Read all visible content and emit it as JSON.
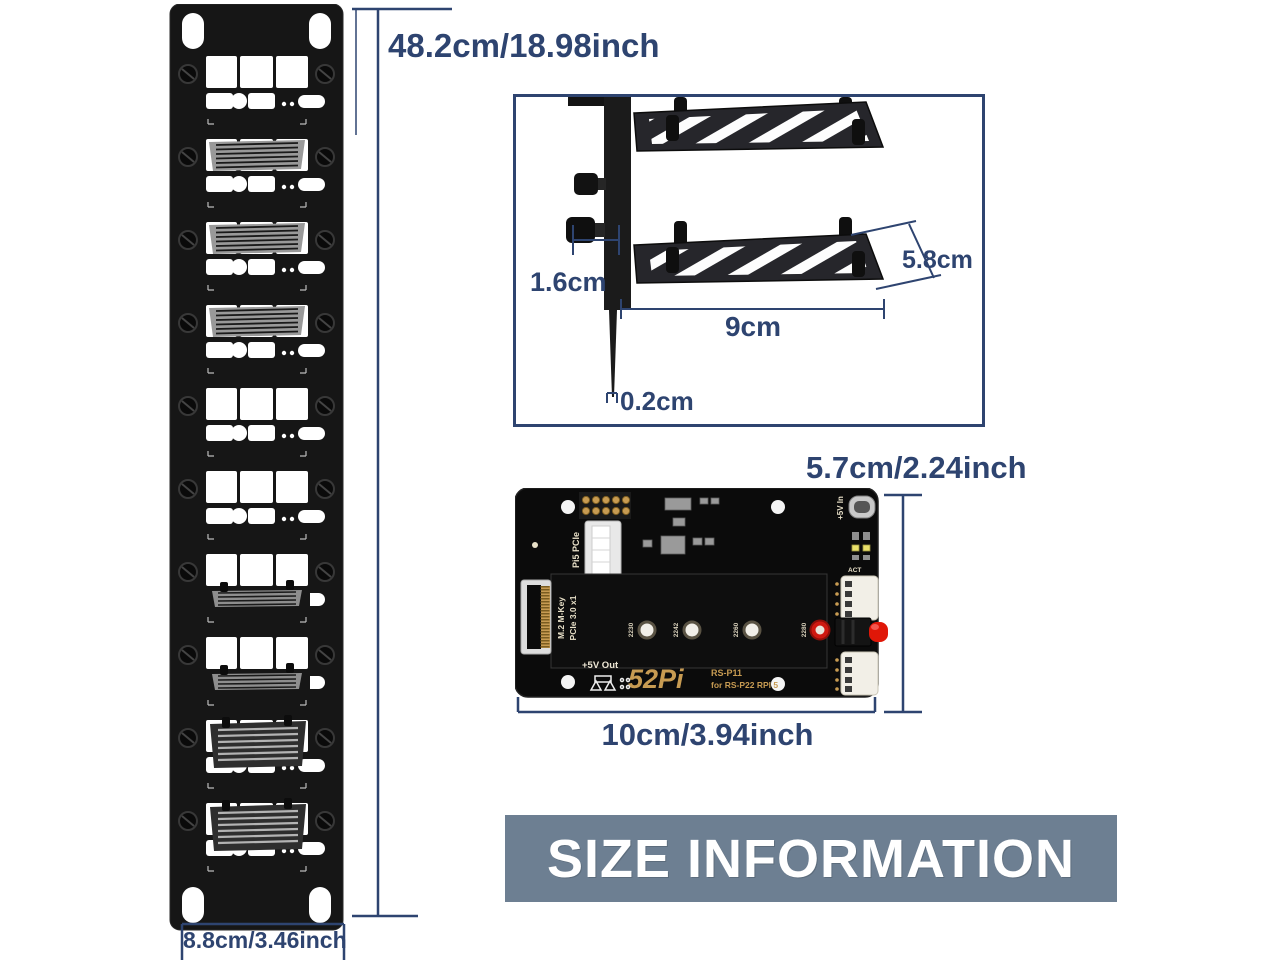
{
  "colors": {
    "dimension": "#2e4470",
    "banner_bg": "#6d7f92",
    "banner_text": "#ffffff",
    "panel_black": "#161616",
    "pcb_black": "#0b0b0b",
    "silk_cream": "#e8e0c8",
    "silk_gold": "#c79b52",
    "button_red": "#e01708"
  },
  "panel": {
    "height_label": "48.2cm/18.98inch",
    "width_label": "8.8cm/3.46inch",
    "sections": [
      "open",
      "vent-top",
      "vent-top",
      "vent-top",
      "open",
      "open",
      "vent-bottom",
      "vent-bottom",
      "vent-mid",
      "vent-mid"
    ]
  },
  "bracket": {
    "offset_label": "1.6cm",
    "width_label": "9cm",
    "depth_label": "5.8cm",
    "thickness_label": "0.2cm"
  },
  "pcb": {
    "height_label": "5.7cm/2.24inch",
    "width_label": "10cm/3.94inch",
    "m2_sizes": [
      "2230",
      "2242",
      "2260",
      "2280"
    ],
    "silk": {
      "pi5_pcie": "Pi5 PCIe",
      "m2_key": "M.2 M-Key",
      "pcie_gen": "PCIe 3.0 x1",
      "v5_out": "+5V Out",
      "logo": "52Pi",
      "model": "RS-P11",
      "for_model": "for RS-P22 RPI 5",
      "v5_in": "+5V In",
      "act": "ACT"
    }
  },
  "banner": {
    "text": "SIZE INFORMATION"
  }
}
